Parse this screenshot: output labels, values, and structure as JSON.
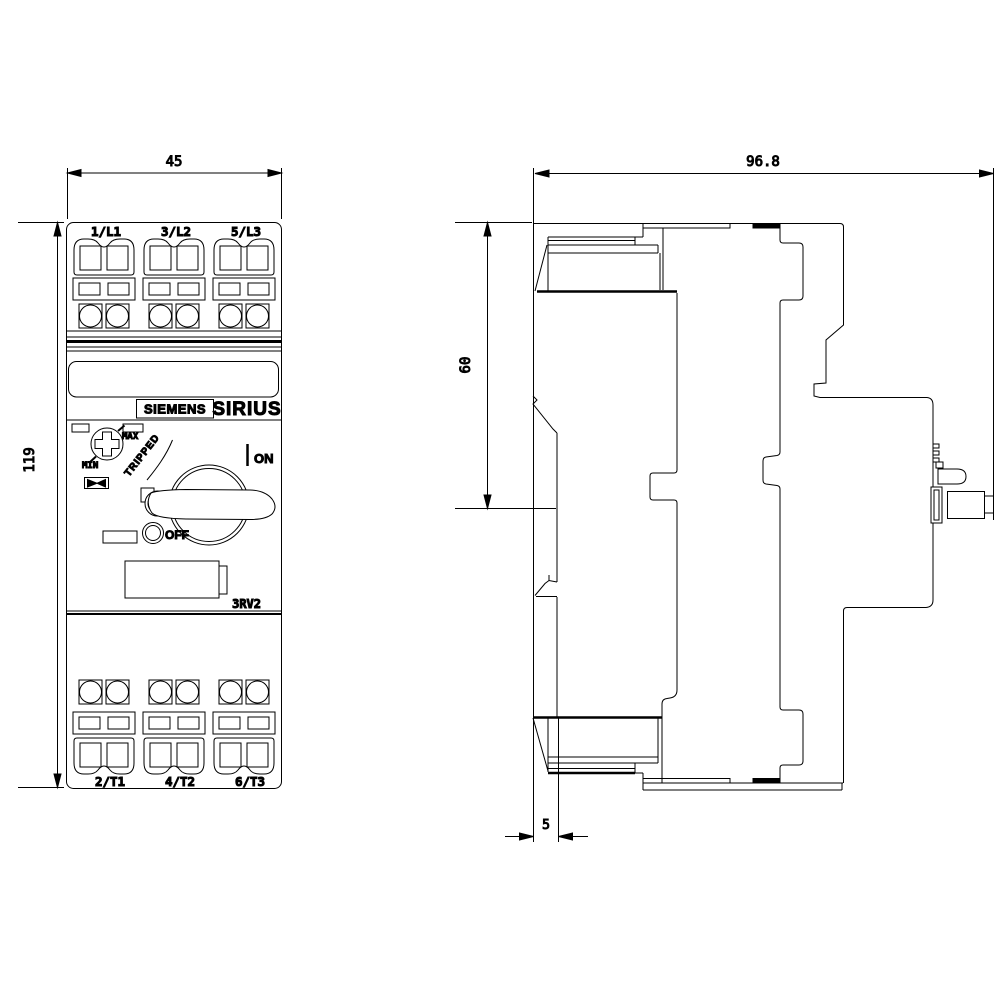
{
  "meta": {
    "brand": "SIEMENS",
    "series": "SIRIUS",
    "model": "3RV2"
  },
  "front_view": {
    "width_mm": "45",
    "height_mm": "119",
    "terminals_top": [
      "1/L1",
      "3/L2",
      "5/L3"
    ],
    "terminals_bottom": [
      "2/T1",
      "4/T2",
      "6/T3"
    ],
    "dial_max": "MAX",
    "dial_min": "MIN",
    "state_on": "ON",
    "state_off": "OFF",
    "state_tripped": "TRIPPED"
  },
  "side_view": {
    "depth_mm": "96.8",
    "upper_height_mm": "60",
    "rail_offset_mm": "5"
  },
  "colors": {
    "line": "#000000",
    "background": "#ffffff"
  }
}
